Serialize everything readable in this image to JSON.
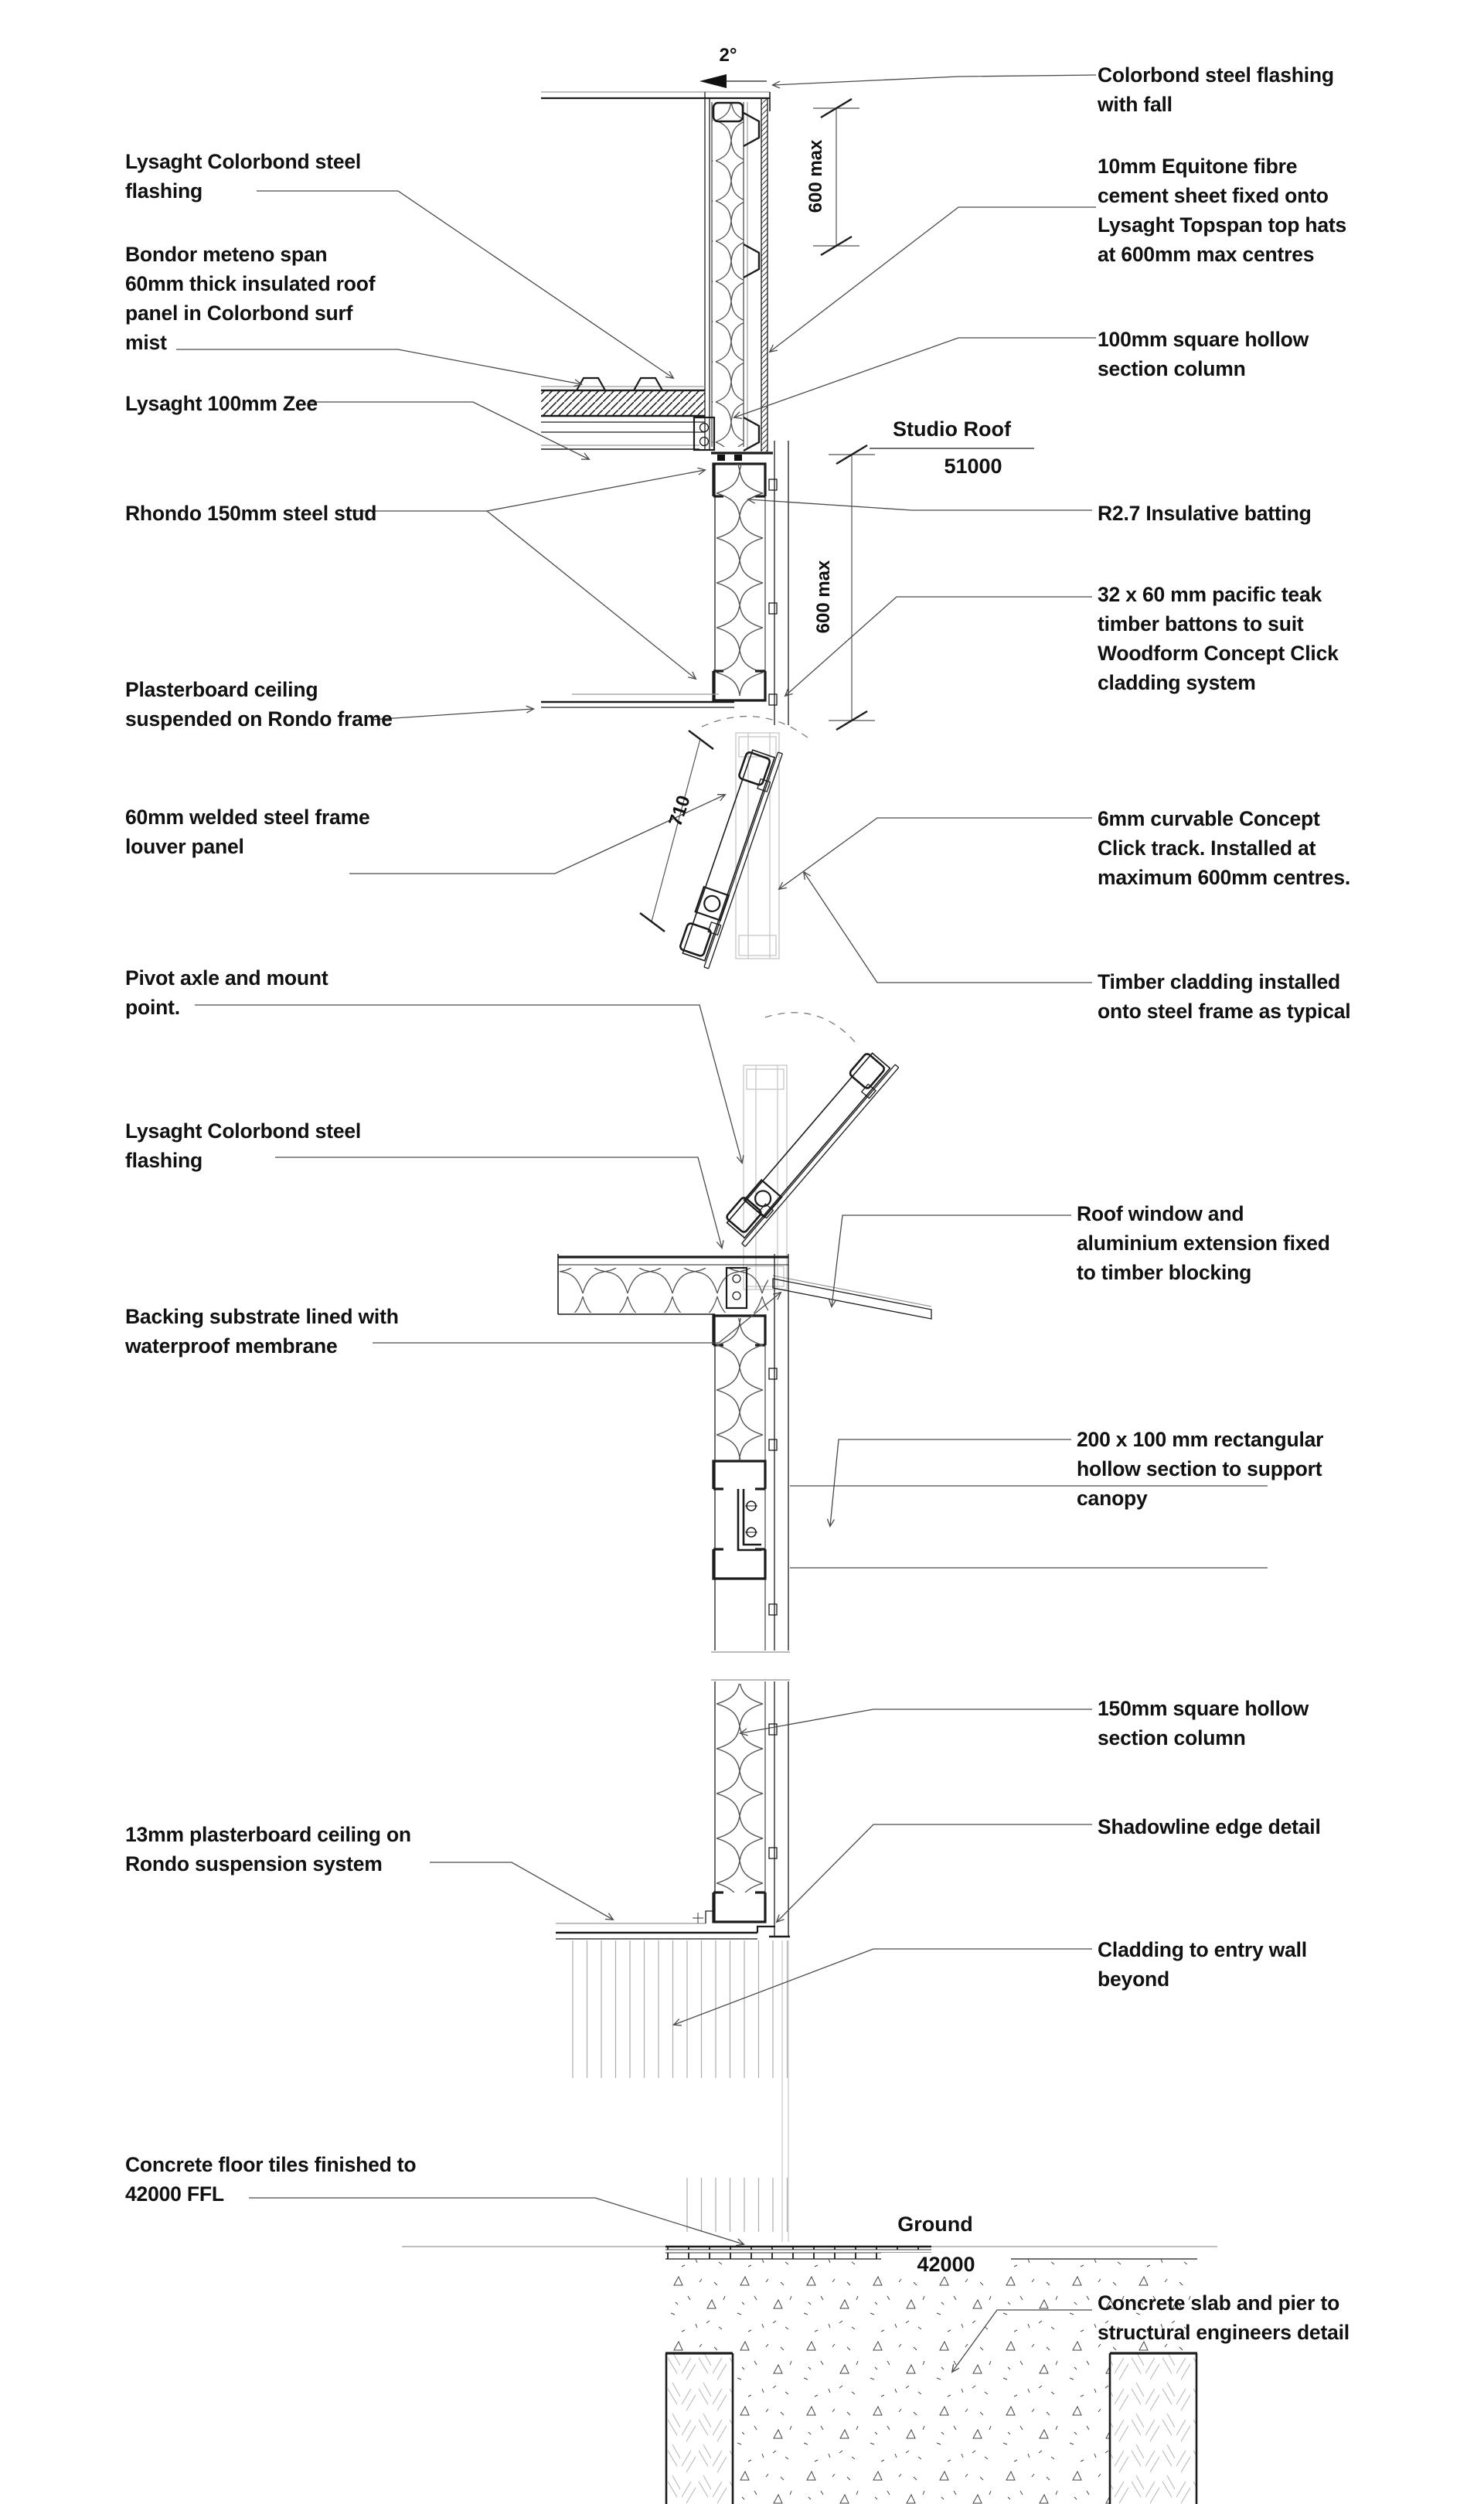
{
  "page": {
    "background": "#ffffff",
    "line_color": "#1c1c1c",
    "leader_color": "#4a4a4a",
    "ghost_color": "#c6c6c6",
    "drawing_type": "architectural wall section detail"
  },
  "levels": {
    "studio_roof": {
      "name": "Studio Roof",
      "elevation": "51000"
    },
    "ground": {
      "name": "Ground",
      "elevation": "42000"
    }
  },
  "dimensions": {
    "roof_fall_angle": "2°",
    "equitone_spacing": "600 max",
    "batten_spacing": "600 max",
    "louver_length": "710"
  },
  "labels_left": [
    {
      "id": "flashing-top",
      "text": "Lysaght Colorbond steel\nflashing"
    },
    {
      "id": "bondor-panel",
      "text": "Bondor meteno span\n60mm thick insulated roof\npanel in Colorbond surf\nmist"
    },
    {
      "id": "zee",
      "text": "Lysaght 100mm Zee"
    },
    {
      "id": "rhondo-stud",
      "text": "Rhondo 150mm steel stud"
    },
    {
      "id": "plasterboard-ceiling",
      "text": "Plasterboard ceiling\nsuspended on Rondo frame"
    },
    {
      "id": "louver-panel",
      "text": "60mm welded steel frame\nlouver panel"
    },
    {
      "id": "pivot-axle",
      "text": "Pivot axle and mount\npoint."
    },
    {
      "id": "flashing-mid",
      "text": "Lysaght Colorbond steel\nflashing"
    },
    {
      "id": "backing-substrate",
      "text": "Backing substrate lined with\nwaterproof membrane"
    },
    {
      "id": "plasterboard-13mm",
      "text": "13mm plasterboard ceiling on\nRondo suspension system"
    },
    {
      "id": "floor-tiles",
      "text": "Concrete floor tiles finished to\n42000 FFL"
    }
  ],
  "labels_right": [
    {
      "id": "colorbond-fall",
      "text": "Colorbond steel flashing\nwith fall"
    },
    {
      "id": "equitone",
      "text": "10mm Equitone fibre\ncement sheet fixed onto\nLysaght Topspan top hats\nat 600mm max centres"
    },
    {
      "id": "shs-100",
      "text": "100mm square hollow\nsection column"
    },
    {
      "id": "batting",
      "text": "R2.7 Insulative batting"
    },
    {
      "id": "teak-battens",
      "text": "32 x 60 mm pacific teak\ntimber battons to suit\nWoodform Concept Click\ncladding system"
    },
    {
      "id": "click-track",
      "text": "6mm curvable Concept\nClick track. Installed at\nmaximum 600mm centres."
    },
    {
      "id": "timber-cladding",
      "text": "Timber cladding installed\nonto steel frame as typical"
    },
    {
      "id": "roof-window",
      "text": "Roof window and\naluminium extension fixed\nto timber blocking"
    },
    {
      "id": "rhs-200x100",
      "text": "200 x 100 mm rectangular\nhollow section to support\ncanopy"
    },
    {
      "id": "shs-150",
      "text": "150mm square hollow\nsection column"
    },
    {
      "id": "shadowline",
      "text": "Shadowline edge detail"
    },
    {
      "id": "cladding-beyond",
      "text": "Cladding to entry wall\nbeyond"
    },
    {
      "id": "concrete-slab",
      "text": "Concrete slab and pier to\nstructural engineers detail"
    }
  ]
}
